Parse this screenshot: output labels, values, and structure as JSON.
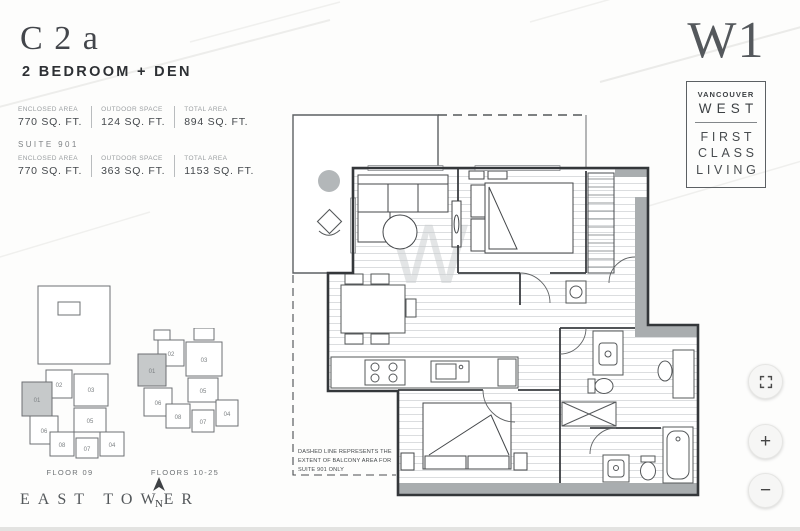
{
  "header": {
    "code": "C2a",
    "type": "2 BEDROOM + DEN"
  },
  "stats": {
    "row1": {
      "c1": {
        "label": "ENCLOSED AREA",
        "value": "770 SQ. FT."
      },
      "c2": {
        "label": "OUTDOOR SPACE",
        "value": "124 SQ. FT."
      },
      "c3": {
        "label": "TOTAL AREA",
        "value": "894 SQ. FT."
      }
    },
    "suite_heading": "SUITE 901",
    "row2": {
      "c1": {
        "label": "ENCLOSED AREA",
        "value": "770 SQ. FT."
      },
      "c2": {
        "label": "OUTDOOR SPACE",
        "value": "363 SQ. FT."
      },
      "c3": {
        "label": "TOTAL AREA",
        "value": "1153 SQ. FT."
      }
    }
  },
  "brand": {
    "logo": "W1",
    "line1": "VANCOUVER",
    "line2": "WEST",
    "line3": "FIRST",
    "line4": "CLASS",
    "line5": "LIVING"
  },
  "plan": {
    "watermark": "W",
    "note1": "DASHED LINE REPRESENTS THE",
    "note2": "EXTENT OF BALCONY AREA FOR",
    "note3": "SUITE 901 ONLY"
  },
  "keyplans": {
    "k1": {
      "caption": "FLOOR 09",
      "units": [
        "02",
        "03",
        "01",
        "05",
        "06",
        "08",
        "07",
        "04"
      ]
    },
    "k2": {
      "caption": "FLOORS 10-25",
      "units": [
        "02",
        "03",
        "01",
        "05",
        "06",
        "08",
        "07",
        "04"
      ]
    },
    "tower": "EAST TOWER",
    "north": "N"
  },
  "controls": {
    "zoom_in": "+",
    "zoom_out": "−"
  },
  "colors": {
    "wall": "#3a3d40",
    "poche": "#a9adaf",
    "highlight_unit": "#c6c9ca",
    "balcony_table": "#b3b7b9"
  }
}
